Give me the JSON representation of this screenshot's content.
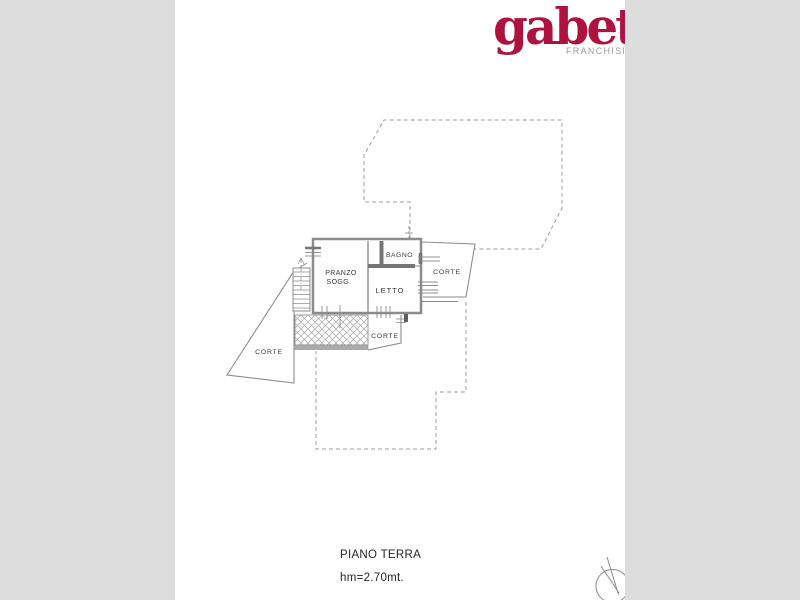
{
  "window": {
    "background_color": "#dcdcdc",
    "paper_color": "#ffffff"
  },
  "logo": {
    "text": "gabetti",
    "subtext": "FRANCHISING",
    "text_color": "#b0123f",
    "subtext_color": "#9b9b9b"
  },
  "plan": {
    "labels": {
      "pranzo_line1": "PRANZO",
      "pranzo_line2": "SOGG.",
      "bagno": "BAGNO",
      "letto": "LETTO",
      "corte_right": "CORTE",
      "corte_bottom": "CORTE",
      "corte_left": "CORTE"
    },
    "caption": {
      "floor": "PIANO TERRA",
      "height": "hm=2.70mt."
    },
    "colors": {
      "wall": "#8c8c8c",
      "thick_wall": "#757575",
      "dashed_boundary": "#9e9e9e",
      "hatch": "#b3b3b3",
      "label_text": "#3a3a3a"
    }
  }
}
